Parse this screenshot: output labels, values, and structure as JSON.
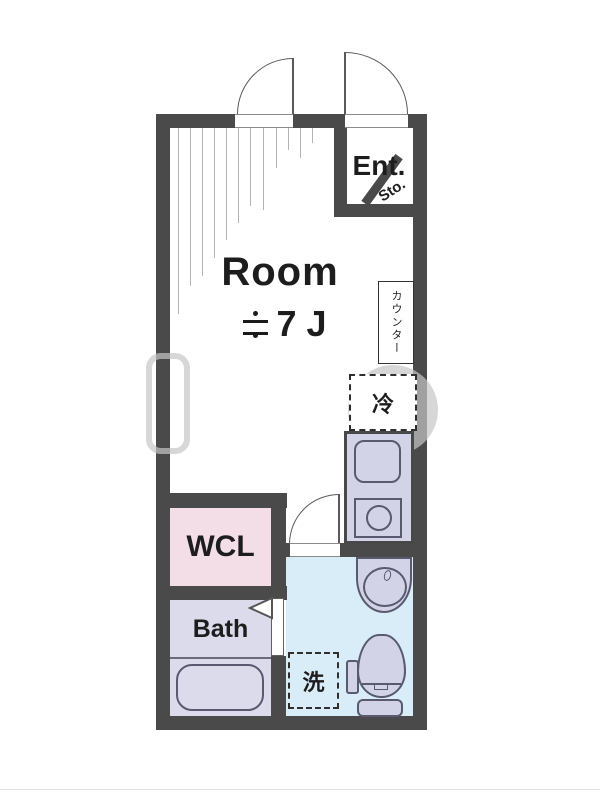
{
  "floor_plan": {
    "rooms": {
      "room": {
        "label": "Room",
        "size_label": "≒7 J",
        "size_value": "7 J"
      },
      "entrance": {
        "label": "Ent."
      },
      "storage": {
        "label": "Sto."
      },
      "counter": {
        "label": "カウンター"
      },
      "refrigerator": {
        "label": "冷"
      },
      "walk_in_closet": {
        "label": "WCL"
      },
      "bath": {
        "label": "Bath"
      },
      "washing_machine": {
        "label": "洗"
      }
    },
    "colors": {
      "wall": "#4a4a4a",
      "room_fill": "#ffffff",
      "walk_in_closet_fill": "#f3dde7",
      "bath_fill": "#dbdbeb",
      "kitchen_fill": "#d2d3e7",
      "bathroom_fill": "#d9edf9",
      "fixture_outline": "#595970",
      "watermark": "#c6c6c6"
    }
  }
}
